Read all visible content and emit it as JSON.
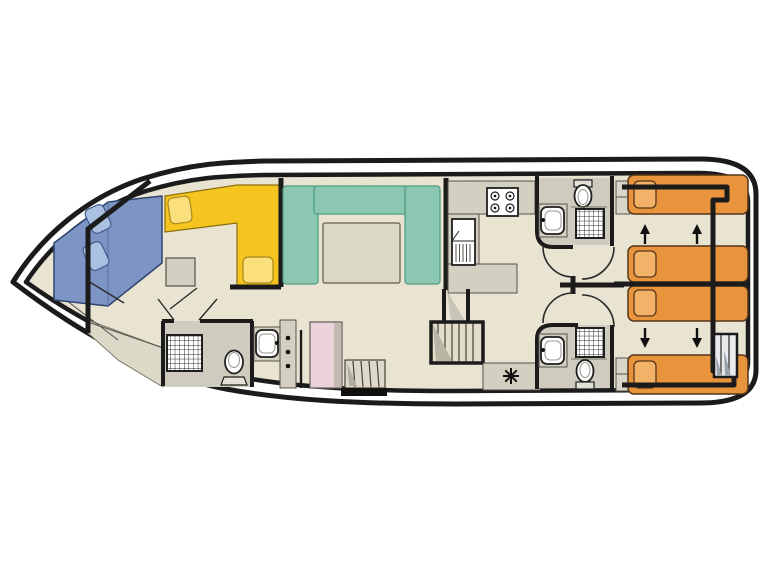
{
  "meta": {
    "title": "Houseboat interior deck floor plan",
    "view": "top-down deck plan, bow left / stern right",
    "visible_text": ""
  },
  "palette": {
    "background": "#ffffff",
    "hull_fill": "#ffffff",
    "wall": "#1b1b1b",
    "floor": "#e9e4d1",
    "bathroom_floor": "#cfccbf",
    "counter_gray": "#d3cfc1",
    "table_gray": "#dcd8c6",
    "shade_gray": "#ddd9c8",
    "sofa_teal": "#8bc7b1",
    "sofa_teal_border": "#4b9a82",
    "seat_yellow": "#f6c41e",
    "seat_yellow_cushion": "#fadf7c",
    "bed_orange": "#e8943d",
    "bed_orange_pillow": "#f2b369",
    "bed_border_brown": "#55341a",
    "berth_blue": "#7d95c4",
    "berth_blue_pillow": "#abc1e1",
    "cabinet_pink": "#ecd2da",
    "cabinet_pink_shadow": "#c4bab2",
    "stair_tread": "#e2deca",
    "stern_stair": "#e8eaee",
    "fixture_white": "#ffffff"
  },
  "inventory": {
    "rooms": [
      {
        "id": "bow-berth-area",
        "desc": "bow double berth (blue) with two pillows"
      },
      {
        "id": "bow-cabin",
        "desc": "forward cabin with L-shaped yellow dinette, two cushions, side table"
      },
      {
        "id": "bow-bathroom",
        "desc": "forward bathroom: shower, toilet, washbasin, hook rail"
      },
      {
        "id": "saloon",
        "desc": "saloon with teal U-shaped sofa and table"
      },
      {
        "id": "galley",
        "desc": "galley: 4-burner stove, fridge, L-shaped counter"
      },
      {
        "id": "midship-stairs",
        "desc": "companionway stairs, side-deck steps and door threshold, helm star marker"
      },
      {
        "id": "corridor",
        "desc": "aft corridor with four door swings"
      },
      {
        "id": "aft-bathroom-top",
        "desc": "aft bathroom (port): toilet, shower, washbasin"
      },
      {
        "id": "aft-bathroom-bottom",
        "desc": "aft bathroom (starboard): washbasin, shower, toilet"
      },
      {
        "id": "stern-cabin-top",
        "desc": "stern cabin with two orange sliding single beds (arrows up)"
      },
      {
        "id": "stern-cabin-bottom",
        "desc": "stern cabin with two orange sliding single beds (arrows down), aft stairs"
      }
    ]
  }
}
